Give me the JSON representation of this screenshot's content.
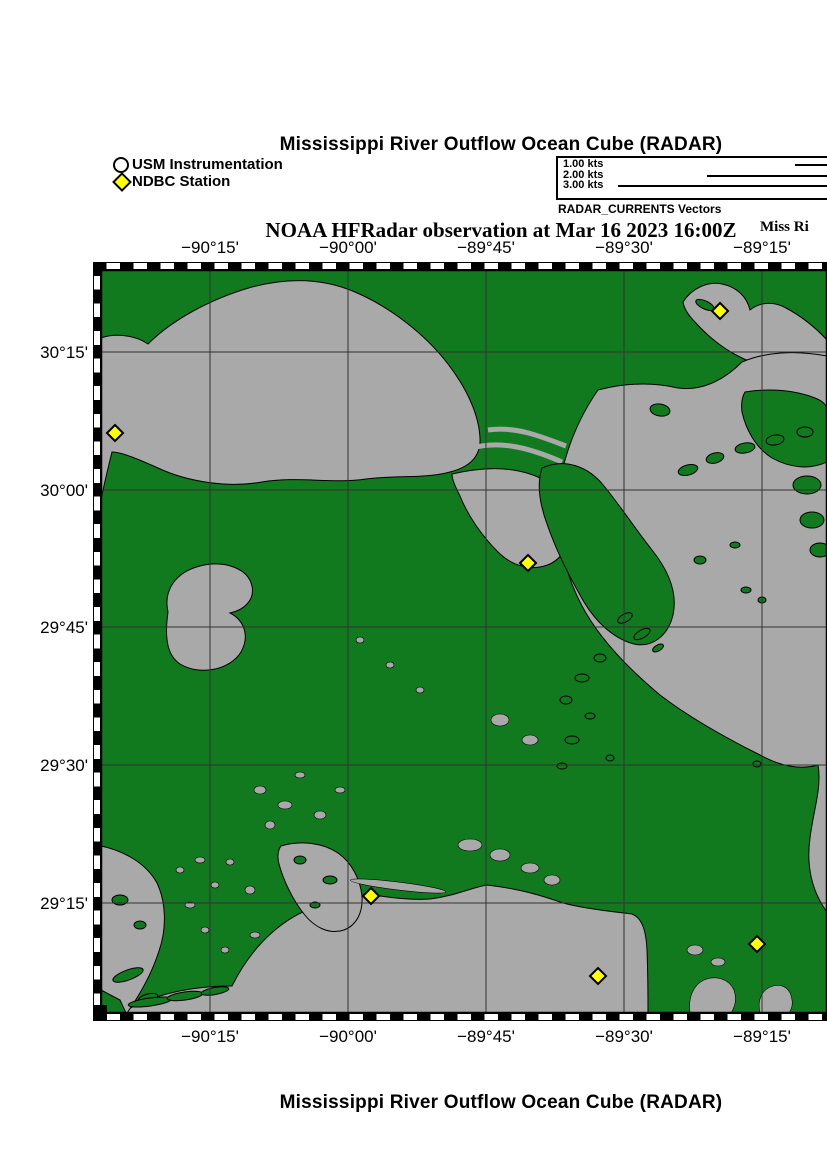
{
  "titles": {
    "top": "Mississippi River Outflow Ocean Cube (RADAR)",
    "bottom": "Mississippi River Outflow Ocean Cube (RADAR)",
    "subtitle": "NOAA HFRadar observation at Mar 16 2023 16:00Z",
    "right_partial": "Miss Ri"
  },
  "symbol_legend": {
    "usm_label": "USM Instrumentation",
    "ndbc_label": "NDBC Station"
  },
  "vector_legend": {
    "caption": "RADAR_CURRENTS Vectors",
    "entries": [
      {
        "label": "1.00 kts",
        "line_start_x": 795
      },
      {
        "label": "2.00 kts",
        "line_start_x": 707
      },
      {
        "label": "3.00 kts",
        "line_start_x": 618
      }
    ]
  },
  "map": {
    "x_axis": {
      "ticks": [
        {
          "label": "−90°15'",
          "x": 210
        },
        {
          "label": "−90°00'",
          "x": 348
        },
        {
          "label": "−89°45'",
          "x": 486
        },
        {
          "label": "−89°30'",
          "x": 624
        },
        {
          "label": "−89°15'",
          "x": 762
        }
      ]
    },
    "y_axis": {
      "ticks": [
        {
          "label": "30°15'",
          "y": 352
        },
        {
          "label": "30°00'",
          "y": 490
        },
        {
          "label": "29°45'",
          "y": 627
        },
        {
          "label": "29°30'",
          "y": 765
        },
        {
          "label": "29°15'",
          "y": 903
        }
      ]
    },
    "ndbc_stations": [
      {
        "x": 720,
        "y": 311
      },
      {
        "x": 115,
        "y": 433
      },
      {
        "x": 528,
        "y": 563
      },
      {
        "x": 371,
        "y": 896
      },
      {
        "x": 757,
        "y": 944
      },
      {
        "x": 598,
        "y": 976
      }
    ],
    "colors": {
      "land": "#117A1E",
      "water": "#A9A9A9",
      "station": "#FFFF00",
      "grid": "#333333",
      "frame": "#000000"
    }
  }
}
